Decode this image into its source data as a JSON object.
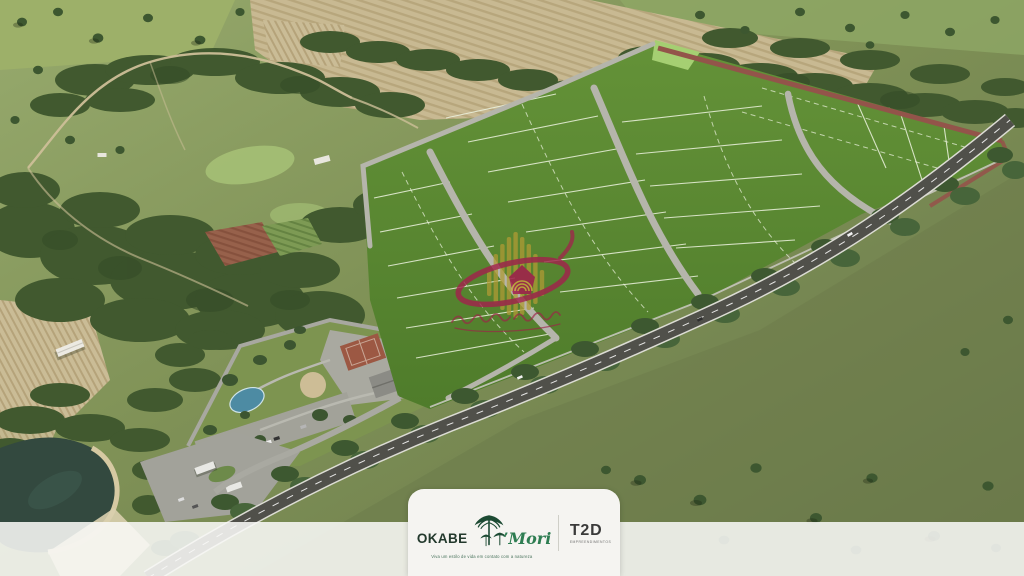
{
  "badge": {
    "brand_primary": "OKABE",
    "brand_secondary": "’Mori",
    "tagline": "Viva um estilo de vida em contato com a natureza",
    "partner": "T2D",
    "partner_subtext": "EMPREENDIMENTOS"
  },
  "watermark": {
    "icon": "tower-bars-house-swoosh-emblem",
    "gold": "#b09a35",
    "crimson": "#a2224c"
  },
  "scene": {
    "type": "aerial-render",
    "elements": [
      "pastures",
      "farm-fields",
      "forest",
      "land-lots",
      "internal-streets",
      "perimeter-track",
      "highway",
      "clubhouse-area",
      "entrance-gate",
      "pond"
    ]
  },
  "colors": {
    "lot_green": "#56862f",
    "pasture_green": "#8a9d63",
    "field_tan": "#c8b992",
    "forest_green": "#41592f",
    "highway_gray": "#50504a",
    "badge_bg": "#f5f4f1"
  }
}
